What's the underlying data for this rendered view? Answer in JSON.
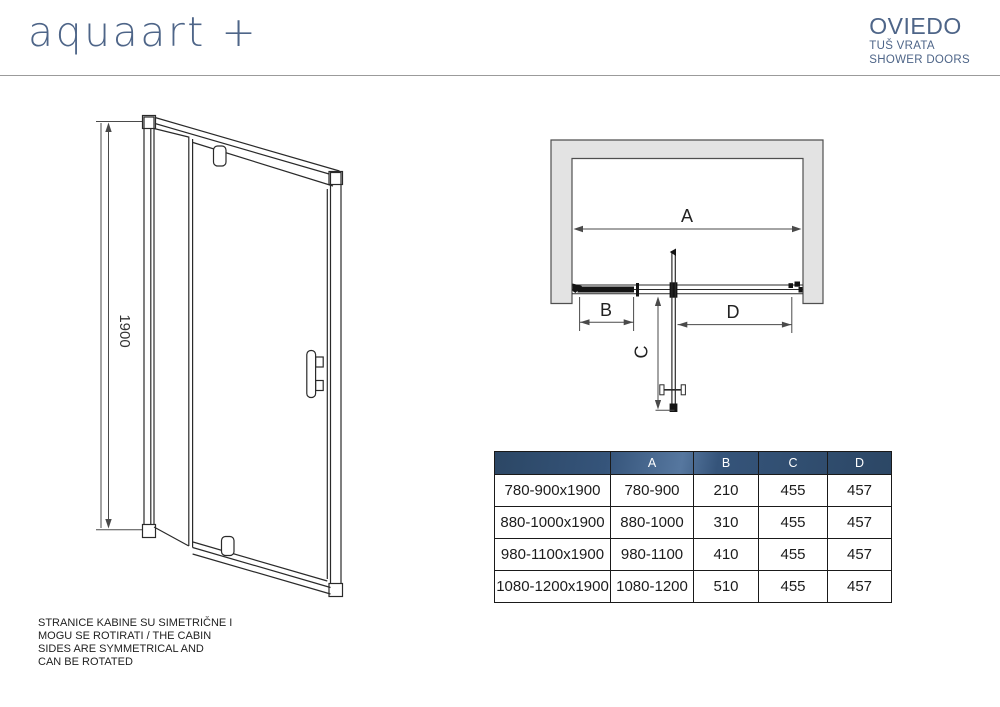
{
  "brand": {
    "logo": "aquaart +"
  },
  "product": {
    "name": "OVIEDO",
    "subtitle_hr": "TUŠ VRATA",
    "subtitle_en": "SHOWER DOORS"
  },
  "colors": {
    "brand_blue": "#4e6588",
    "table_header_navy": "#35547a",
    "wall_gray": "#e3e3e3",
    "line_black": "#2a2a2a"
  },
  "front_view": {
    "height_label": "1900"
  },
  "top_view": {
    "dim_a": "A",
    "dim_b": "B",
    "dim_c": "C",
    "dim_d": "D"
  },
  "table": {
    "columns": [
      "",
      "A",
      "B",
      "C",
      "D"
    ],
    "rows": [
      [
        "780-900x1900",
        "780-900",
        "210",
        "455",
        "457"
      ],
      [
        "880-1000x1900",
        "880-1000",
        "310",
        "455",
        "457"
      ],
      [
        "980-1100x1900",
        "980-1100",
        "410",
        "455",
        "457"
      ],
      [
        "1080-1200x1900",
        "1080-1200",
        "510",
        "455",
        "457"
      ]
    ]
  },
  "note": {
    "line1": "STRANICE KABINE SU SIMETRIČNE I",
    "line2": "MOGU SE ROTIRATI / THE CABIN",
    "line3": "SIDES ARE SYMMETRICAL AND",
    "line4": "CAN BE ROTATED"
  }
}
